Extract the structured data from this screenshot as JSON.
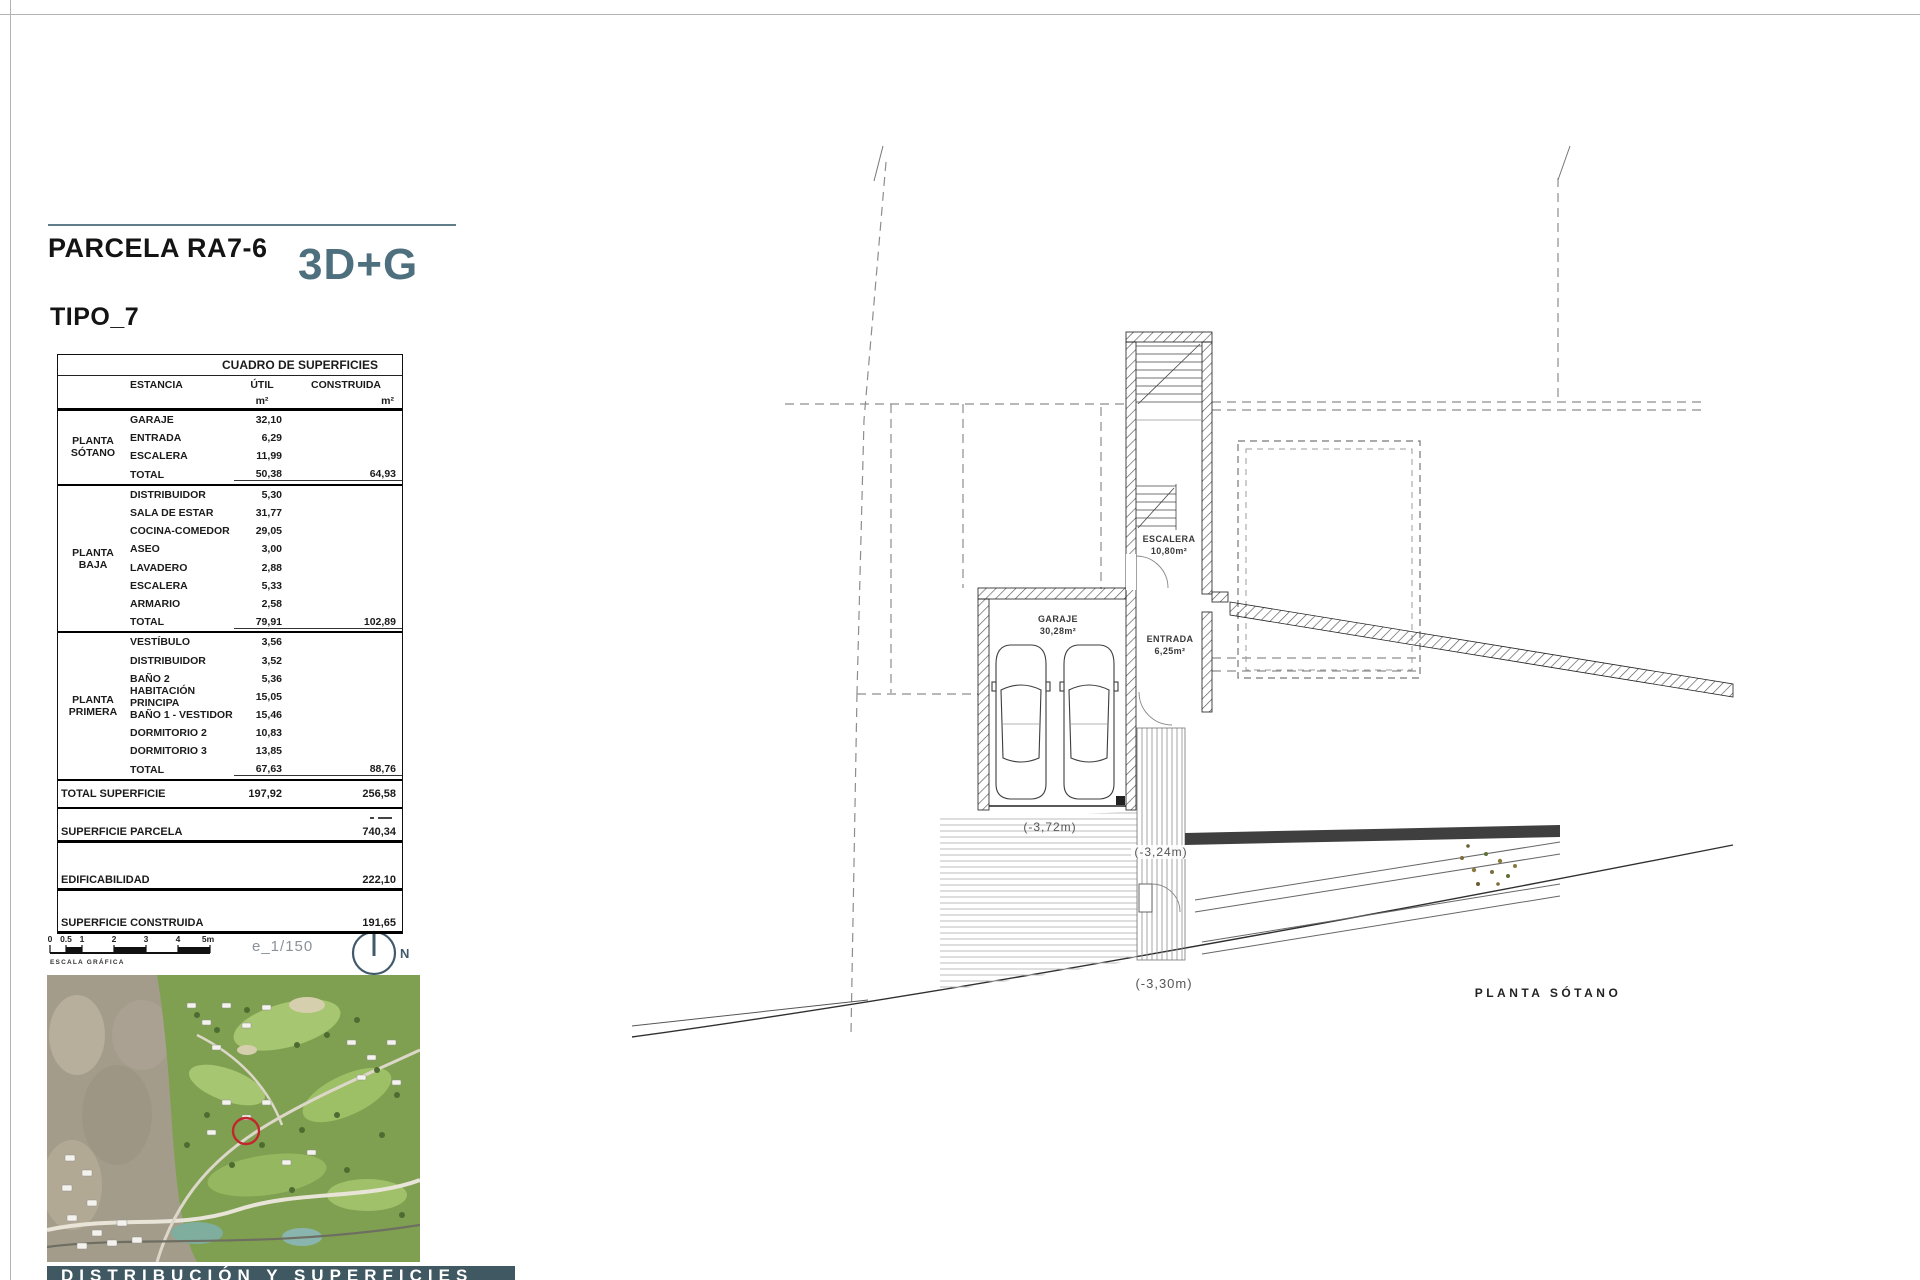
{
  "header": {
    "parcel_title": "PARCELA RA7-6",
    "type_badge": "3D+G",
    "tipo_label": "TIPO_7"
  },
  "surface_table": {
    "title": "CUADRO DE SUPERFICIES",
    "columns": {
      "estancia": "ESTANCIA",
      "util": "ÚTIL",
      "construida": "CONSTRUIDA",
      "unit": "m²"
    },
    "sections": [
      {
        "floor": "PLANTA SÓTANO",
        "rows": [
          {
            "name": "GARAJE",
            "util": "32,10"
          },
          {
            "name": "ENTRADA",
            "util": "6,29"
          },
          {
            "name": "ESCALERA",
            "util": "11,99"
          }
        ],
        "total": {
          "name": "TOTAL",
          "util": "50,38",
          "construida": "64,93"
        }
      },
      {
        "floor": "PLANTA BAJA",
        "rows": [
          {
            "name": "DISTRIBUIDOR",
            "util": "5,30"
          },
          {
            "name": "SALA DE ESTAR",
            "util": "31,77"
          },
          {
            "name": "COCINA-COMEDOR",
            "util": "29,05"
          },
          {
            "name": "ASEO",
            "util": "3,00"
          },
          {
            "name": "LAVADERO",
            "util": "2,88"
          },
          {
            "name": "ESCALERA",
            "util": "5,33"
          },
          {
            "name": "ARMARIO",
            "util": "2,58"
          }
        ],
        "total": {
          "name": "TOTAL",
          "util": "79,91",
          "construida": "102,89"
        }
      },
      {
        "floor": "PLANTA PRIMERA",
        "rows": [
          {
            "name": "VESTÍBULO",
            "util": "3,56"
          },
          {
            "name": "DISTRIBUIDOR",
            "util": "3,52"
          },
          {
            "name": "BAÑO 2",
            "util": "5,36"
          },
          {
            "name": "HABITACIÓN PRINCIPA",
            "util": "15,05"
          },
          {
            "name": "BAÑO 1 - VESTIDOR",
            "util": "15,46"
          },
          {
            "name": "DORMITORIO 2",
            "util": "10,83"
          },
          {
            "name": "DORMITORIO 3",
            "util": "13,85"
          }
        ],
        "total": {
          "name": "TOTAL",
          "util": "67,63",
          "construida": "88,76"
        }
      }
    ],
    "grand_total": {
      "label": "TOTAL SUPERFICIE",
      "util": "197,92",
      "construida": "256,58"
    },
    "summary_rows": [
      {
        "label": "SUPERFICIE PARCELA",
        "value": "740,34"
      },
      {
        "label": "EDIFICABILIDAD",
        "value": "222,10"
      },
      {
        "label": "SUPERFICIE CONSTRUIDA",
        "value": "191,65"
      }
    ]
  },
  "scale": {
    "ticks": [
      "0",
      "0.5",
      "1",
      "2",
      "3",
      "4",
      "5m"
    ],
    "caption": "ESCALA GRÁFICA",
    "ratio": "e_1/150",
    "north": "N"
  },
  "plan": {
    "title": "PLANTA SÓTANO",
    "rooms": {
      "garage": {
        "name": "GARAJE",
        "area": "30,28m²"
      },
      "stairs": {
        "name": "ESCALERA",
        "area": "10,80m²"
      },
      "entry": {
        "name": "ENTRADA",
        "area": "6,25m²"
      }
    },
    "levels": [
      "(-3,72m)",
      "(-3,24m)",
      "(-3,30m)"
    ]
  },
  "footer": {
    "bar_label": "DISTRIBUCIÓN Y SUPERFICIES"
  },
  "colors": {
    "accent": "#4e707e",
    "footer_bar": "#3f5862",
    "marker_red": "#c1272d"
  }
}
